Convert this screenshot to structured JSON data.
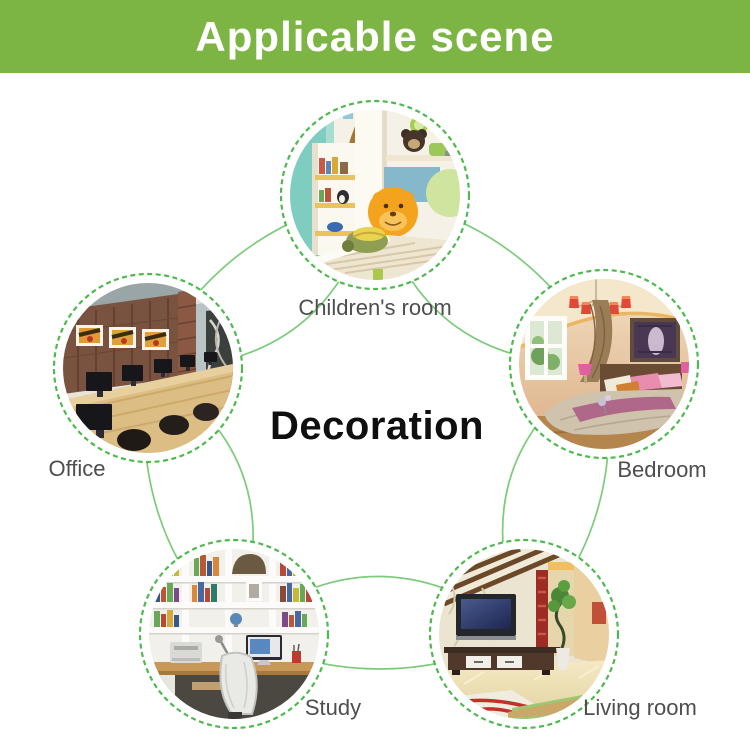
{
  "header": {
    "title": "Applicable scene",
    "bg_color": "#7cb544",
    "text_color": "#ffffff"
  },
  "center_label": "Decoration",
  "scenes": [
    {
      "id": "childrens-room",
      "label": "Children's room"
    },
    {
      "id": "office",
      "label": "Office"
    },
    {
      "id": "bedroom",
      "label": "Bedroom"
    },
    {
      "id": "study",
      "label": "Study"
    },
    {
      "id": "living-room",
      "label": "Living room"
    }
  ],
  "colors": {
    "ring_dash_green": "#4eb94e",
    "connector_green": "#7ecb7e",
    "label_gray": "#4e4e4e",
    "center_text": "#0f0f0f"
  }
}
